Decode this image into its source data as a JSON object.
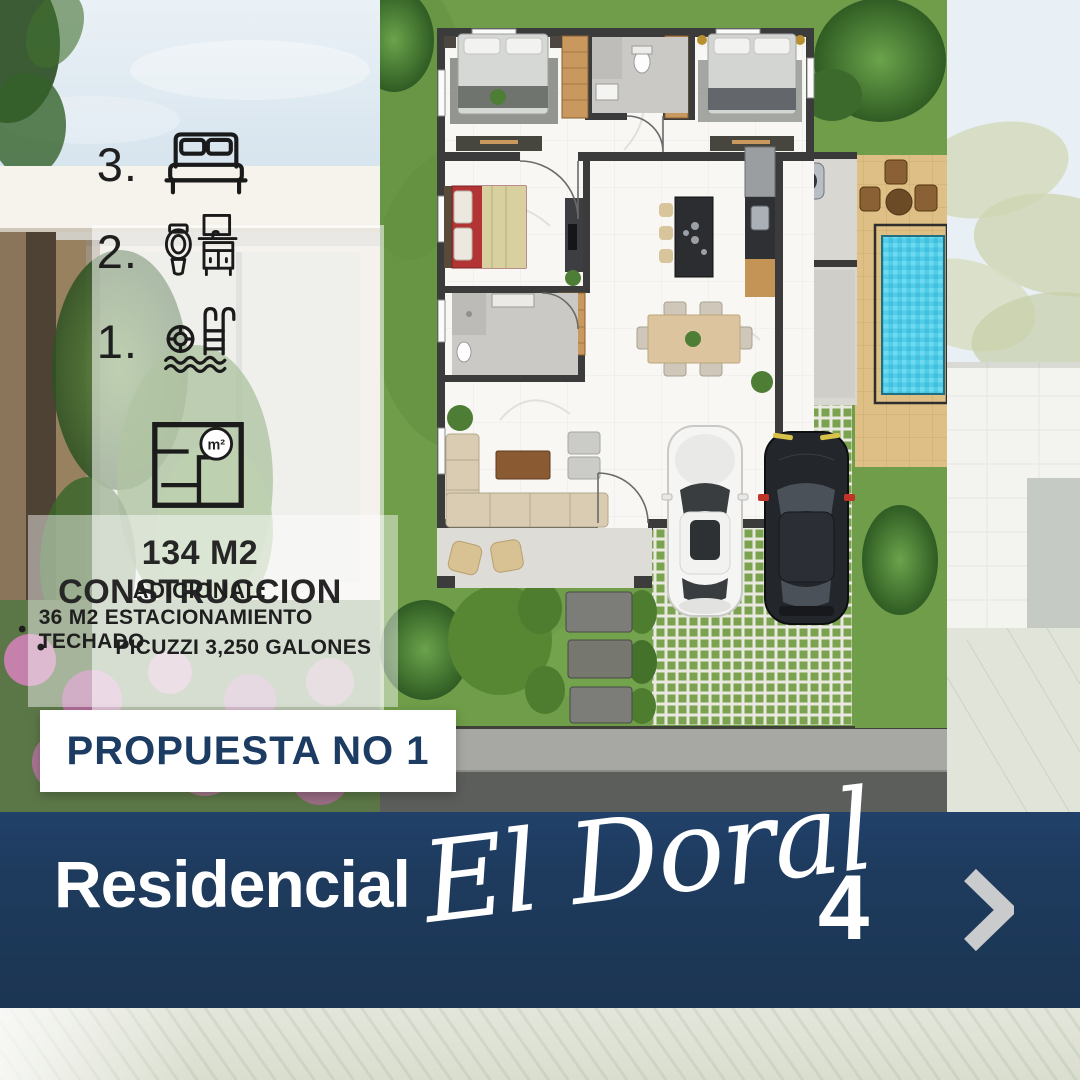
{
  "features": [
    {
      "count": "3.",
      "icon": "bed-icon"
    },
    {
      "count": "2.",
      "icon": "bathroom-icon"
    },
    {
      "count": "1.",
      "icon": "pool-icon"
    }
  ],
  "area": {
    "m2_icon_label": "m²",
    "title": "134 M2 CONSTRUCCION",
    "additional_label": "ADICIONAL:",
    "bullets": [
      "36 M2 ESTACIONAMIENTO TECHADO",
      "PICUZZI 3,250 GALONES"
    ]
  },
  "proposal": {
    "label": "PROPUESTA NO 1"
  },
  "banner": {
    "prefix": "Residencial",
    "script": "El Doral",
    "number": "4",
    "chevron": "❯"
  },
  "colors": {
    "navy": "#1e3b5e",
    "proposal_text": "#1d3c63",
    "chevron_gray": "#c9cbcd",
    "pool_blue": "#4fcde9",
    "grass_green": "#6f9d49",
    "deck_tan": "#debf85",
    "wall_dark": "#3b3b3c",
    "road_gray": "#5c5e5c"
  }
}
